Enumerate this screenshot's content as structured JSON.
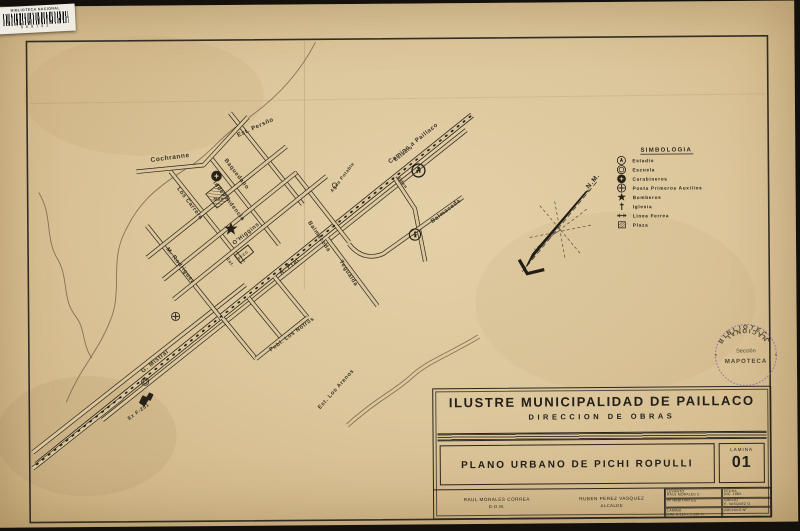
{
  "colors": {
    "paper": "#dcc69b",
    "ink": "#2b261d",
    "stamp_purple": "#8a63ac",
    "stamp_pink": "#bd6fa0"
  },
  "sticker": {
    "library": "BIBLIOTECA NACIONAL",
    "number": "989792"
  },
  "stamp": {
    "arc_top": "BIBLIOTECA",
    "arc_bottom": "NACIONAL",
    "center_line1": "Sección",
    "center_line2": "MAPOTECA"
  },
  "north": {
    "label": "N.M."
  },
  "legend": {
    "title": "SIMBOLOGIA",
    "items": [
      {
        "icon": "stadium-icon",
        "label": "Estadio"
      },
      {
        "icon": "school-icon",
        "label": "Escuela"
      },
      {
        "icon": "carabineros-icon",
        "label": "Carabineros"
      },
      {
        "icon": "first-aid-icon",
        "label": "Posta Primeros Auxilios"
      },
      {
        "icon": "fire-station-icon",
        "label": "Bomberos"
      },
      {
        "icon": "church-icon",
        "label": "Iglesia"
      },
      {
        "icon": "railway-icon",
        "label": "Linea Ferrea"
      },
      {
        "icon": "plaza-icon",
        "label": "Plaza"
      }
    ]
  },
  "map": {
    "labels": [
      {
        "text": "Cochranne",
        "x": 176,
        "y": 154,
        "rot": -7,
        "size": 6.5
      },
      {
        "text": "Est. Persño",
        "x": 262,
        "y": 124,
        "rot": -24,
        "size": 6
      },
      {
        "text": "Camino a Paillaco",
        "x": 420,
        "y": 141,
        "rot": -38,
        "size": 6
      },
      {
        "text": "Agua Potable",
        "x": 349,
        "y": 174,
        "rot": -52,
        "size": 4.6
      },
      {
        "text": "Estadio",
        "x": 410,
        "y": 151,
        "rot": -38,
        "size": 5
      },
      {
        "text": "Eden",
        "x": 407,
        "y": 180,
        "rot": 54,
        "size": 4.4
      },
      {
        "text": "Baquedano",
        "x": 241,
        "y": 170,
        "rot": 53,
        "size": 5.8
      },
      {
        "text": "Los Carrera",
        "x": 194,
        "y": 199,
        "rot": 53,
        "size": 5.8
      },
      {
        "text": "Independencia",
        "x": 233,
        "y": 197,
        "rot": 53,
        "size": 5.8
      },
      {
        "text": "M. Rodriguez",
        "x": 184,
        "y": 261,
        "rot": 53,
        "size": 5.8
      },
      {
        "text": "O'Higgins",
        "x": 252,
        "y": 230,
        "rot": -38,
        "size": 5.8
      },
      {
        "text": "Est.",
        "x": 234,
        "y": 258,
        "rot": 53,
        "size": 4.6
      },
      {
        "text": "Balmaceda",
        "x": 323,
        "y": 233,
        "rot": 56,
        "size": 5.8
      },
      {
        "text": "Balmaceda",
        "x": 452,
        "y": 209,
        "rot": -37,
        "size": 5.8
      },
      {
        "text": "Tegualda",
        "x": 352,
        "y": 270,
        "rot": 58,
        "size": 5.8
      },
      {
        "text": "A. Prat",
        "x": 295,
        "y": 263,
        "rot": -38,
        "size": 6
      },
      {
        "text": "G. Mistral",
        "x": 160,
        "y": 357,
        "rot": -38,
        "size": 6
      },
      {
        "text": "Pobl. Los Notros",
        "x": 297,
        "y": 331,
        "rot": -36,
        "size": 5.6
      },
      {
        "text": "Est. Los Arenos",
        "x": 341,
        "y": 386,
        "rot": -48,
        "size": 5.6
      },
      {
        "text": "Ex F-281",
        "x": 143,
        "y": 407,
        "rot": -36,
        "size": 5
      },
      {
        "text": "Mun",
        "x": 224,
        "y": 195,
        "rot": 0,
        "size": 4.2
      },
      {
        "text": "FFCC",
        "x": 249,
        "y": 251,
        "rot": -38,
        "size": 3.8
      }
    ],
    "features": [
      {
        "icon": "carabineros-icon",
        "x": 222,
        "y": 171,
        "s": 1.15
      },
      {
        "icon": "fire-station-icon",
        "x": 236,
        "y": 224,
        "s": 1.5
      },
      {
        "icon": "first-aid-icon",
        "x": 180,
        "y": 311,
        "s": 0.95
      },
      {
        "icon": "school-icon",
        "x": 149,
        "y": 376,
        "s": 0.85
      },
      {
        "icon": "stadium-icon",
        "x": 424,
        "y": 167,
        "s": 1.5
      },
      {
        "icon": "figure-circle-icon",
        "x": 420,
        "y": 231,
        "s": 1.25
      },
      {
        "icon": "water-icon",
        "x": 340,
        "y": 181,
        "s": 0.8
      }
    ]
  },
  "title_block": {
    "municipality": "ILUSTRE MUNICIPALIDAD DE PAILLACO",
    "department": "DIRECCION DE OBRAS",
    "plan_title": "PLANO URBANO DE PICHI ROPULLI",
    "sheet_label": "LAMINA",
    "sheet_number": "01",
    "author_name": "RAUL MORALES CORREA",
    "author_role": "D.O.M.",
    "approver_name": "RUBEN PEREZ VASQUEZ",
    "approver_role": "ALCALDE",
    "cells": [
      {
        "label": "LEVANTO",
        "value": "RAUL MORALES C."
      },
      {
        "label": "FECHA",
        "value": "DIC. 1983"
      },
      {
        "label": "Nº HABITANTES",
        "value": ""
      },
      {
        "label": "DIBUJO",
        "value": "E. VASQUEZ G."
      },
      {
        "label": "LAMINA",
        "value": "DIM. 0.315 x 1.195 m."
      },
      {
        "label": "ARCHIVO Nº",
        "value": ""
      }
    ]
  }
}
